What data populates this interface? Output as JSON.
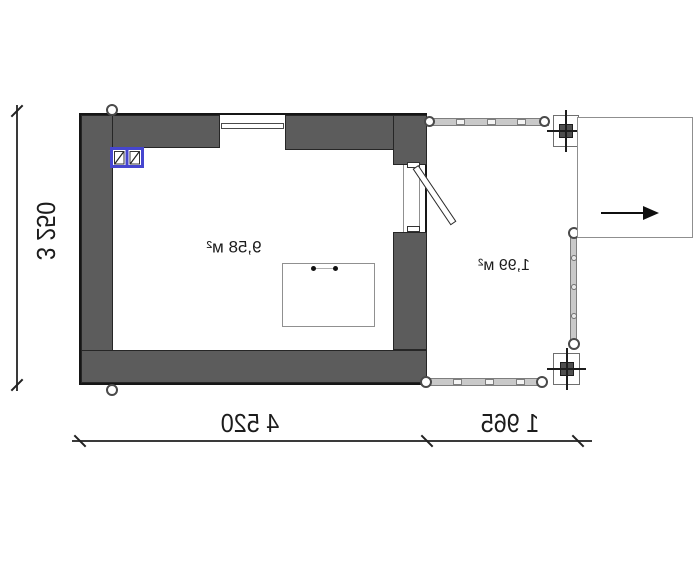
{
  "plan": {
    "rooms": [
      {
        "name": "main-room",
        "area_label": "9,58 м²"
      },
      {
        "name": "porch",
        "area_label": "1,99 м²"
      }
    ],
    "dimensions": {
      "vertical": "3 250",
      "building_width": "4 520",
      "porch_width": "1 965"
    },
    "symbols": {
      "entrance_arrow": "arrow-right-icon",
      "window": "window-icon",
      "wall_vent": "blue-window-symbol-icon",
      "door": "door-swing-icon",
      "column": "column-crosshair-icon",
      "railing": "railing-icon"
    },
    "colors": {
      "wall": "#5c5c5c",
      "wall_outline": "#161616",
      "railing": "#c9c9c9",
      "accent_blue": "#4646cf",
      "dimension": "#1c1c1c",
      "background": "#ffffff"
    }
  }
}
